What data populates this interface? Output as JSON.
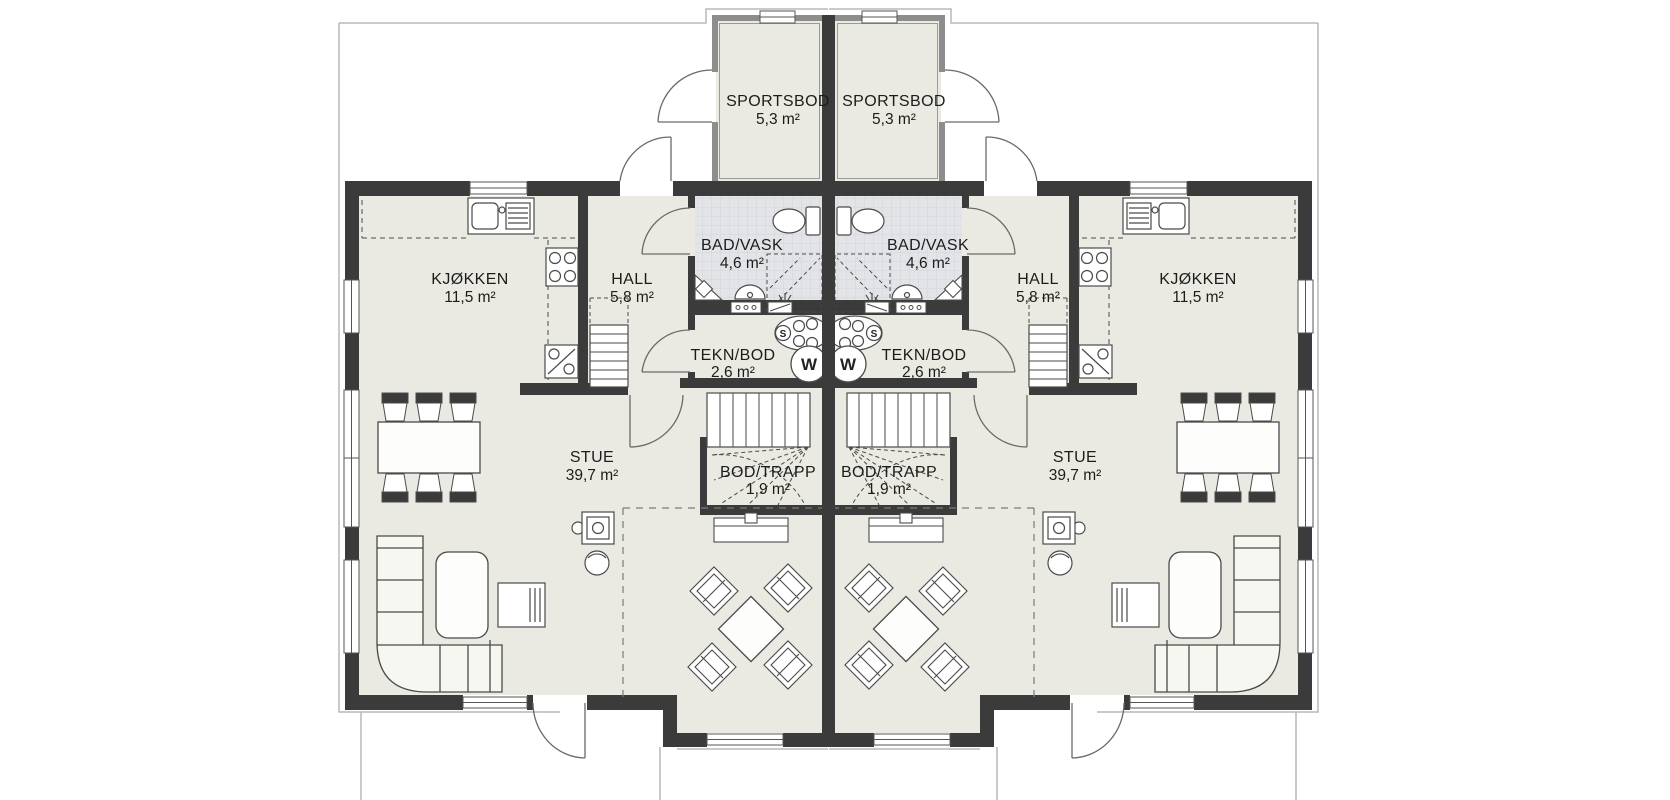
{
  "plan": {
    "type": "duplex-floor-plan",
    "units": {
      "left": {
        "sportsbod": {
          "name": "SPORTSBOD",
          "area": "5,3 m²"
        },
        "bad_vask": {
          "name": "BAD/VASK",
          "area": "4,6 m²"
        },
        "hall": {
          "name": "HALL",
          "area": "5,8 m²"
        },
        "kjokken": {
          "name": "KJØKKEN",
          "area": "11,5 m²"
        },
        "tekn_bod": {
          "name": "TEKN/BOD",
          "area": "2,6 m²"
        },
        "bod_trapp": {
          "name": "BOD/TRAPP",
          "area": "1,9 m²"
        },
        "stue": {
          "name": "STUE",
          "area": "39,7 m²"
        }
      },
      "right": {
        "sportsbod": {
          "name": "SPORTSBOD",
          "area": "5,3 m²"
        },
        "bad_vask": {
          "name": "BAD/VASK",
          "area": "4,6 m²"
        },
        "hall": {
          "name": "HALL",
          "area": "5,8 m²"
        },
        "kjokken": {
          "name": "KJØKKEN",
          "area": "11,5 m²"
        },
        "tekn_bod": {
          "name": "TEKN/BOD",
          "area": "2,6 m²"
        },
        "bod_trapp": {
          "name": "BOD/TRAPP",
          "area": "1,9 m²"
        },
        "stue": {
          "name": "STUE",
          "area": "39,7 m²"
        }
      }
    },
    "appliances": {
      "washer_label": "W",
      "pipe_cabinet_label": "S"
    },
    "colors": {
      "wall": "#3b3b3b",
      "floor": "#eaeae3",
      "bath_floor": "#e3e4e8",
      "line": "#4a4a4a",
      "light_line": "#b9b9b9",
      "background": "#ffffff"
    }
  }
}
